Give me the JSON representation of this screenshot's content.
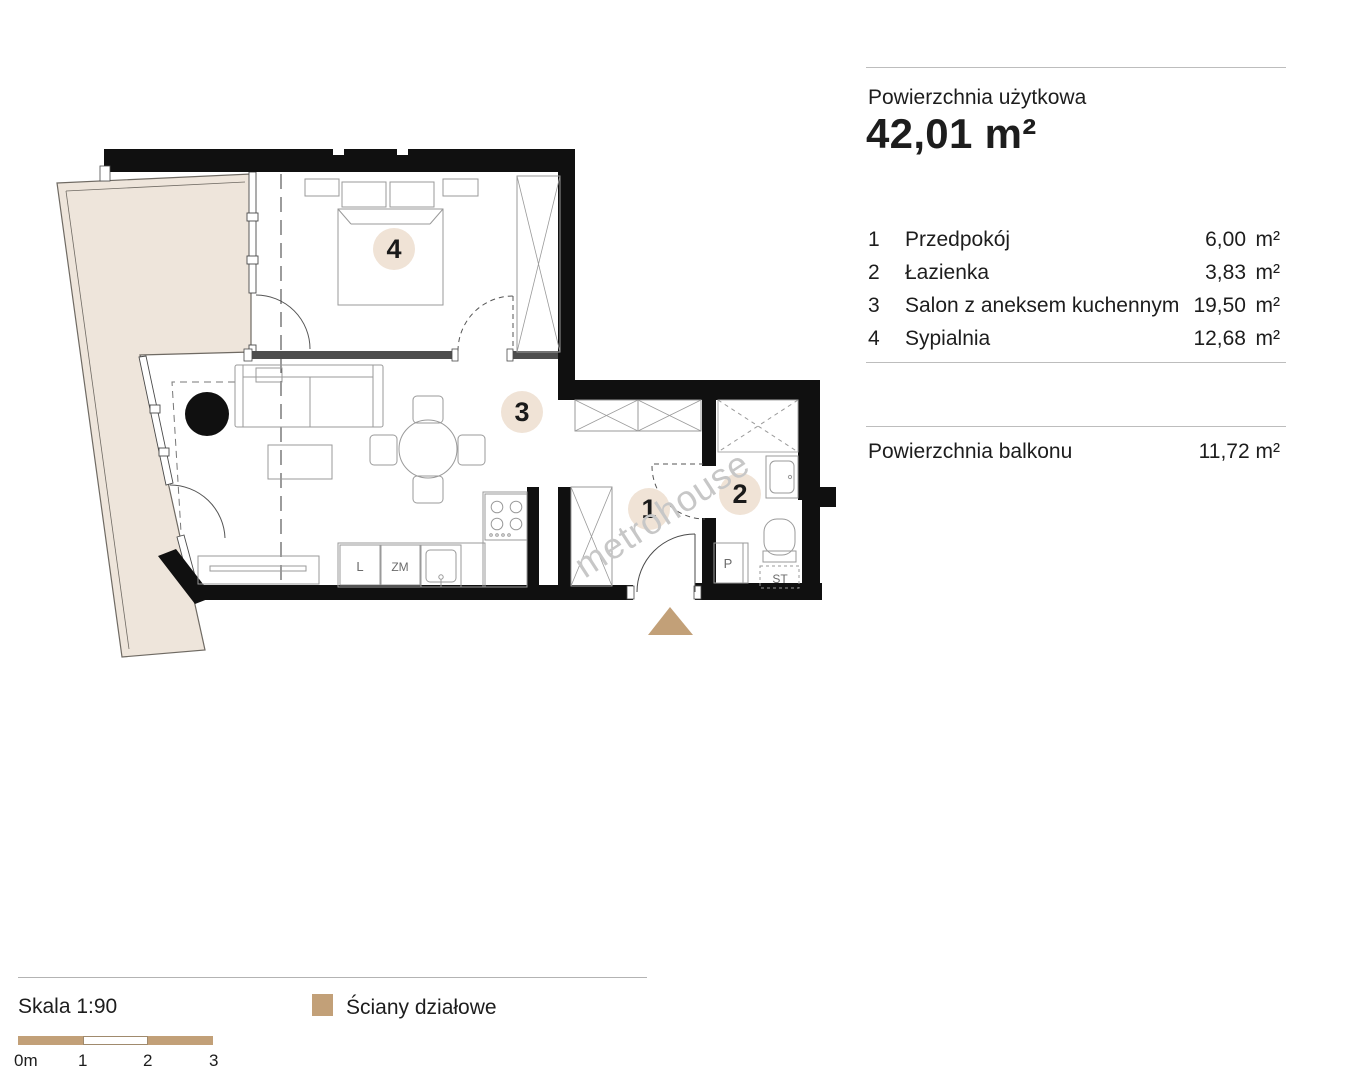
{
  "info": {
    "usable_area_label": "Powierzchnia użytkowa",
    "usable_area_value": "42,01 m²",
    "rooms": [
      {
        "num": "1",
        "name": "Przedpokój",
        "area": "6,00",
        "unit": "m²"
      },
      {
        "num": "2",
        "name": "Łazienka",
        "area": "3,83",
        "unit": "m²"
      },
      {
        "num": "3",
        "name": "Salon z aneksem kuchennym",
        "area": "19,50",
        "unit": "m²"
      },
      {
        "num": "4",
        "name": "Sypialnia",
        "area": "12,68",
        "unit": "m²"
      }
    ],
    "balcony_label": "Powierzchnia balkonu",
    "balcony_value": "11,72 m²"
  },
  "plan": {
    "badges": {
      "hall": "1",
      "bathroom": "2",
      "living": "3",
      "bedroom": "4"
    },
    "labels": {
      "fridge": "L",
      "dishwasher": "ZM",
      "washing_machine": "P",
      "st": "ST"
    },
    "watermark": "metrohouse",
    "colors": {
      "wall": "#101010",
      "balcony_fill": "#eee5db",
      "accent_tan": "#c2a078",
      "badge_fill": "#f0e3d6"
    }
  },
  "footer": {
    "scale_label": "Skala 1:90",
    "legend_label": "Ściany działowe",
    "ticks": [
      "0m",
      "1",
      "2",
      "3"
    ]
  }
}
